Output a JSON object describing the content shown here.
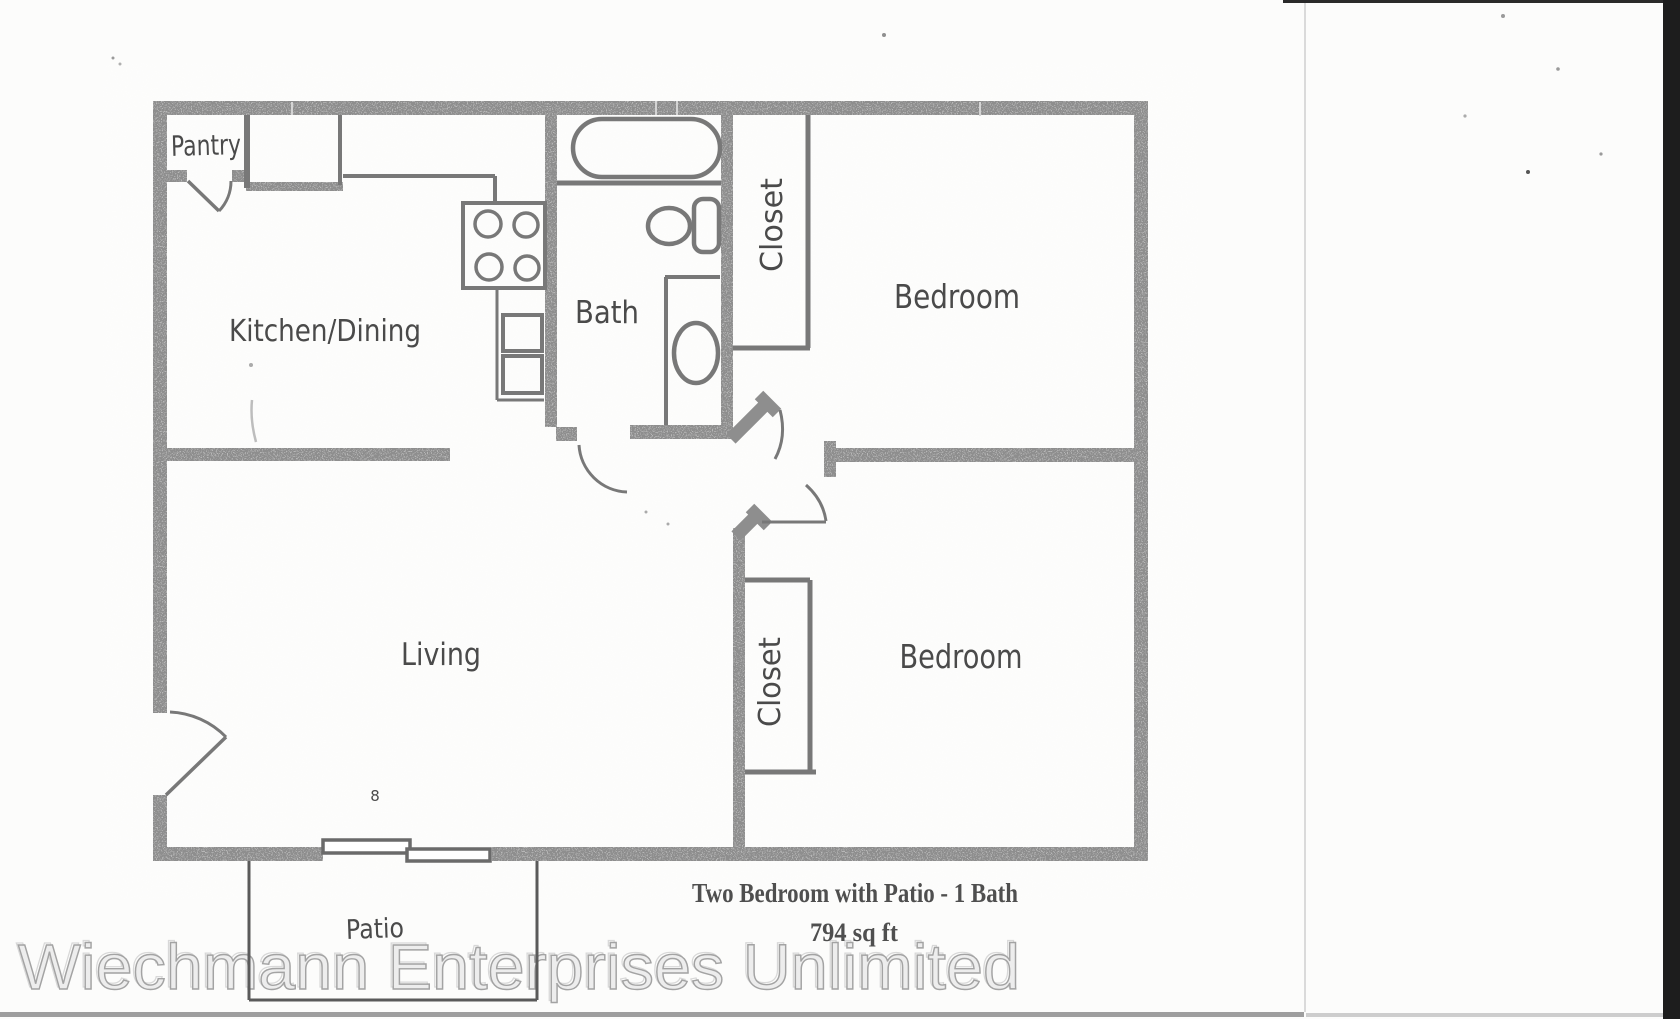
{
  "floorplan": {
    "rooms": {
      "pantry": "Pantry",
      "kitchen_dining": "Kitchen/Dining",
      "bath": "Bath",
      "closet_top": "Closet",
      "bedroom_top": "Bedroom",
      "living": "Living",
      "closet_bottom": "Closet",
      "bedroom_bottom": "Bedroom",
      "patio": "Patio"
    },
    "caption": {
      "line1": "Two Bedroom with Patio - 1 Bath",
      "line2": "794 sq ft"
    },
    "watermark": "Wiechmann Enterprises Unlimited",
    "artifact_mark": "8",
    "colors": {
      "wall": "#8e8e8e",
      "fixture": "#787878",
      "label": "#4a4a4a",
      "caption": "#4f4f4f",
      "watermark_fill": "#ededed",
      "watermark_outline": "#a3a3a3",
      "patio_line": "#5a5a5a",
      "page_bg": "#fcfcfb",
      "edge_strip": "#1d1d1d"
    }
  }
}
